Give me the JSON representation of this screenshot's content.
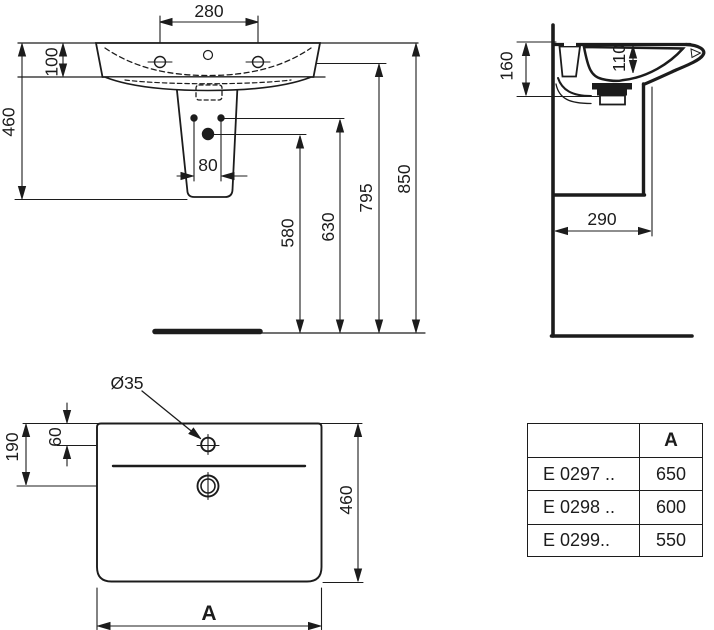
{
  "drawing": {
    "front_view": {
      "dims": {
        "tap_spacing": "280",
        "basin_height": "100",
        "unit_height": "460",
        "bolt_spacing": "80",
        "drain_height": "580",
        "bolt_height": "630",
        "front_edge_height": "795",
        "rim_height": "850"
      }
    },
    "side_view": {
      "dims": {
        "back_depth": "160",
        "bowl_depth": "110",
        "pedestal_clearance": "290"
      }
    },
    "top_view": {
      "dims": {
        "tap_hole_diameter": "Ø35",
        "tap_hole_offset": "60",
        "drain_offset": "190",
        "basin_depth": "460",
        "width_label": "A"
      }
    },
    "table": {
      "header": {
        "model": "",
        "a": "A"
      },
      "rows": [
        {
          "model": "E 0297 ..",
          "a": "650"
        },
        {
          "model": "E 0298 ..",
          "a": "600"
        },
        {
          "model": "E 0299..",
          "a": "550"
        }
      ]
    }
  },
  "colors": {
    "ink": "#1c1c1c",
    "background": "#ffffff"
  }
}
